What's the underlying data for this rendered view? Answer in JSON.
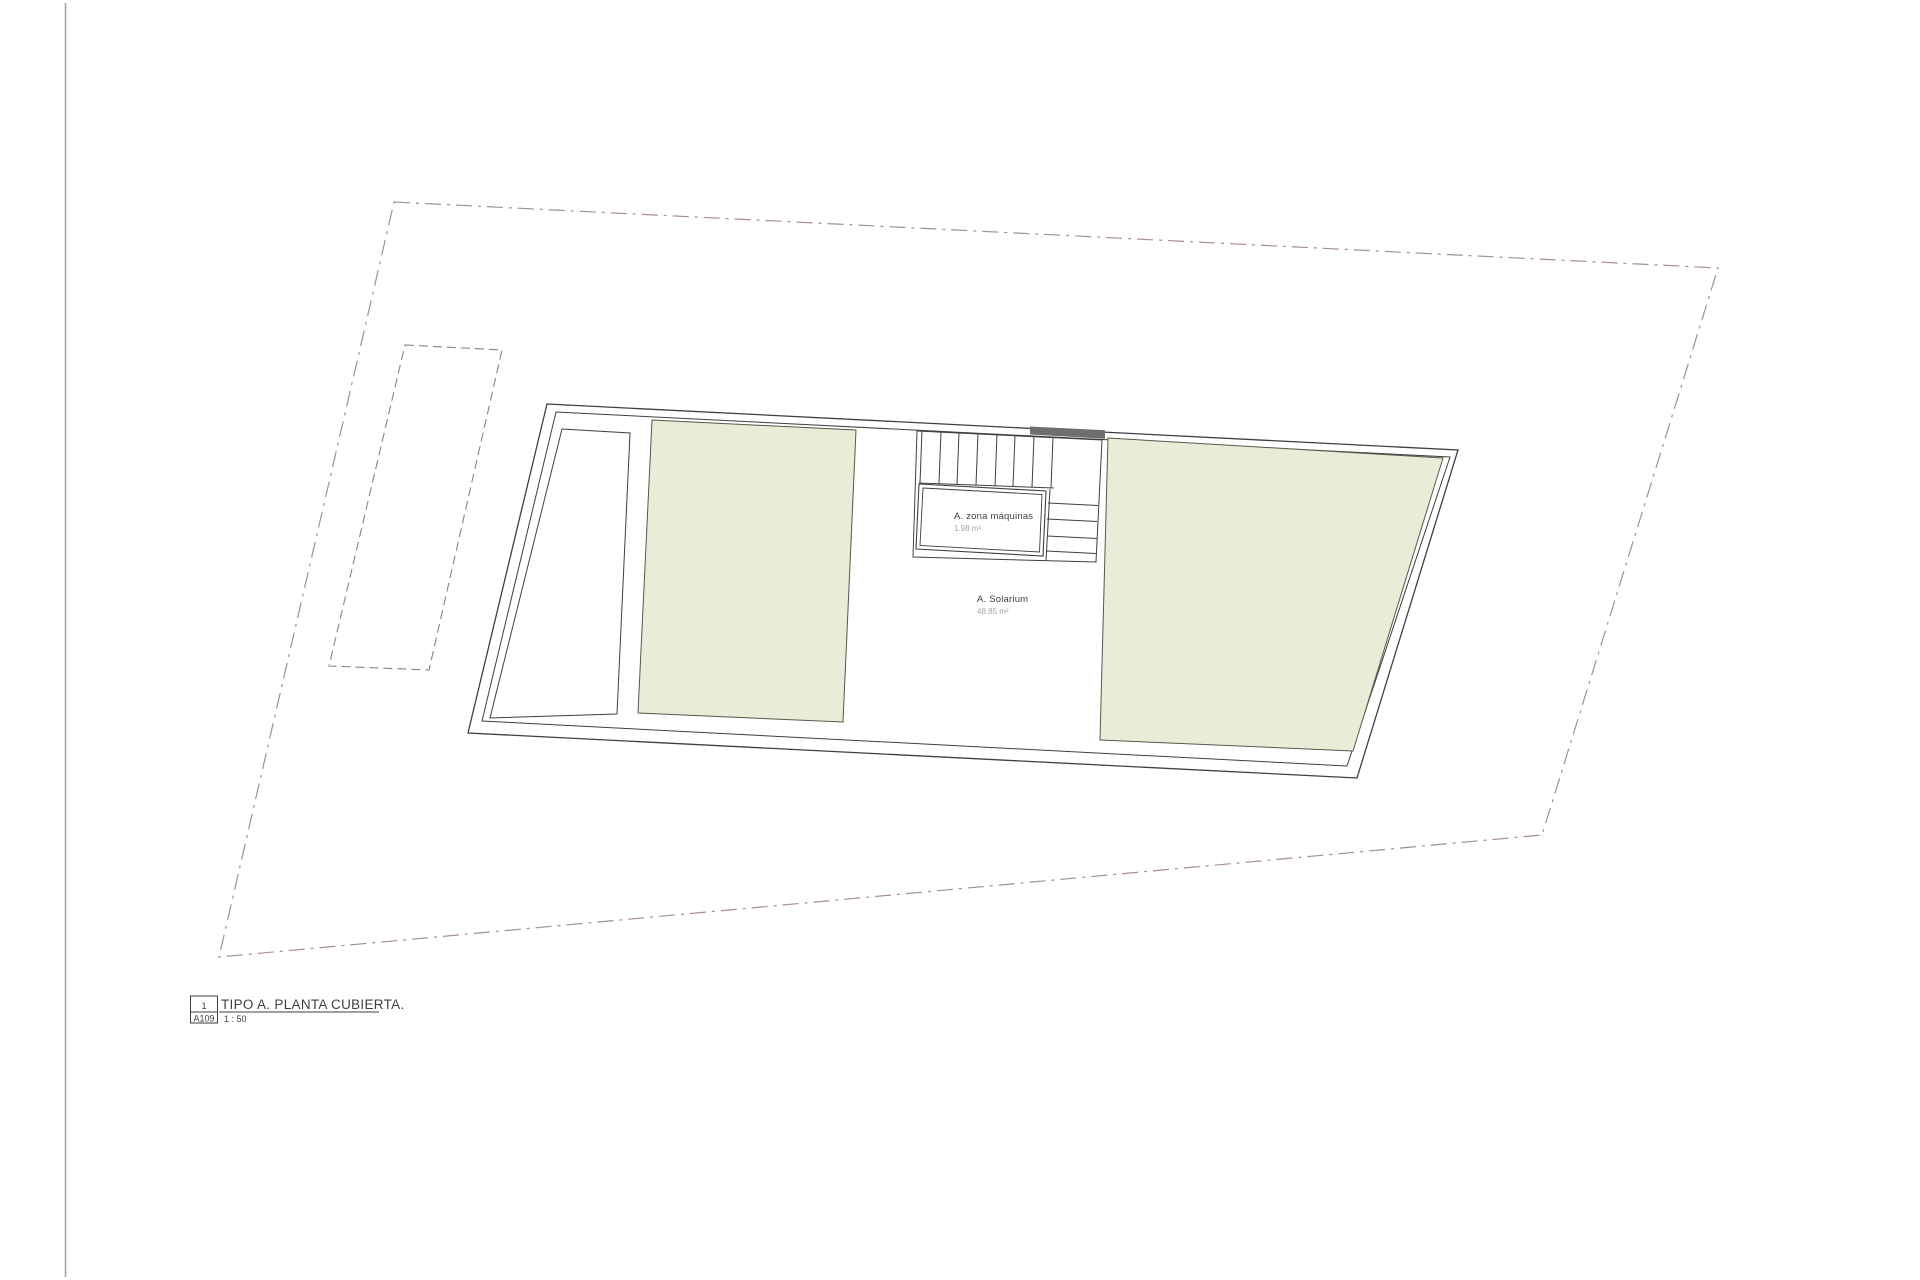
{
  "plan": {
    "machine_room": {
      "label": "A. zona máquinas",
      "area": "1.98 m²"
    },
    "solarium": {
      "label": "A. Solarium",
      "area": "48.85 m²"
    }
  },
  "title_block": {
    "number": "1",
    "sheet": "A109",
    "title": "TIPO A. PLANTA CUBIERTA.",
    "scale": "1 : 50"
  },
  "colors": {
    "green_roof": "#e9edd8",
    "green_edge": "#55584a",
    "drawing_line": "#3f3f3f",
    "boundary_line": "#a6908b",
    "dashed_outline": "#858585",
    "sheet_edge": "#a0a0a0",
    "muted_text": "#a6a6a6",
    "dark_fill": "#6e6e6e"
  }
}
